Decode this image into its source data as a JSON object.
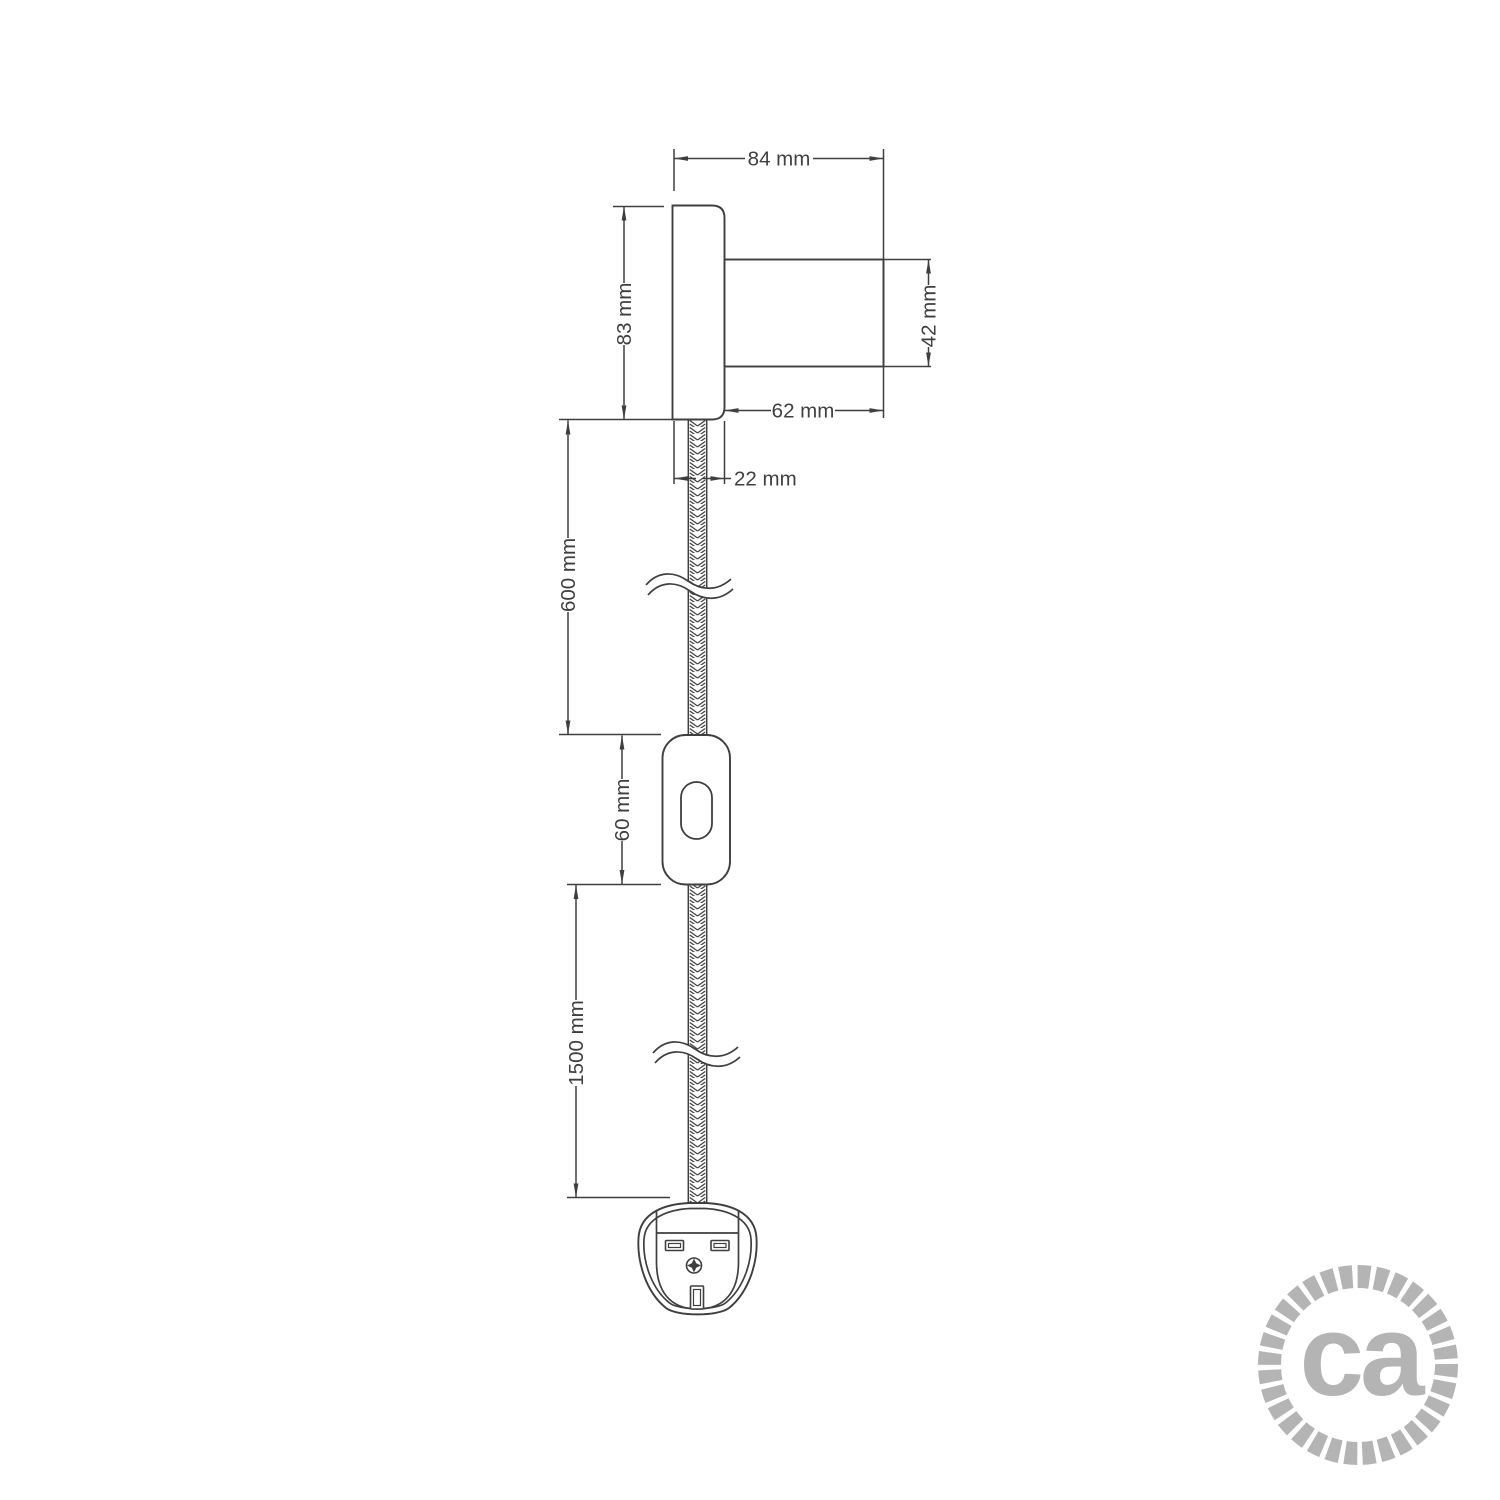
{
  "drawing": {
    "type": "technical-dimension-drawing",
    "subject": "wall-light-with-cable-switch-and-plug",
    "line_color": "#3f3f3f",
    "background": "#ffffff",
    "labels": {
      "overall_depth": "84 mm",
      "plate_height": "83 mm",
      "cylinder_diameter": "42 mm",
      "cylinder_length": "62 mm",
      "plate_thickness": "22 mm",
      "upper_cable_length": "600 mm",
      "switch_length": "60 mm",
      "lower_cable_length": "1500 mm"
    }
  },
  "logo": {
    "text": "ca",
    "color": "#b4b4b4"
  }
}
